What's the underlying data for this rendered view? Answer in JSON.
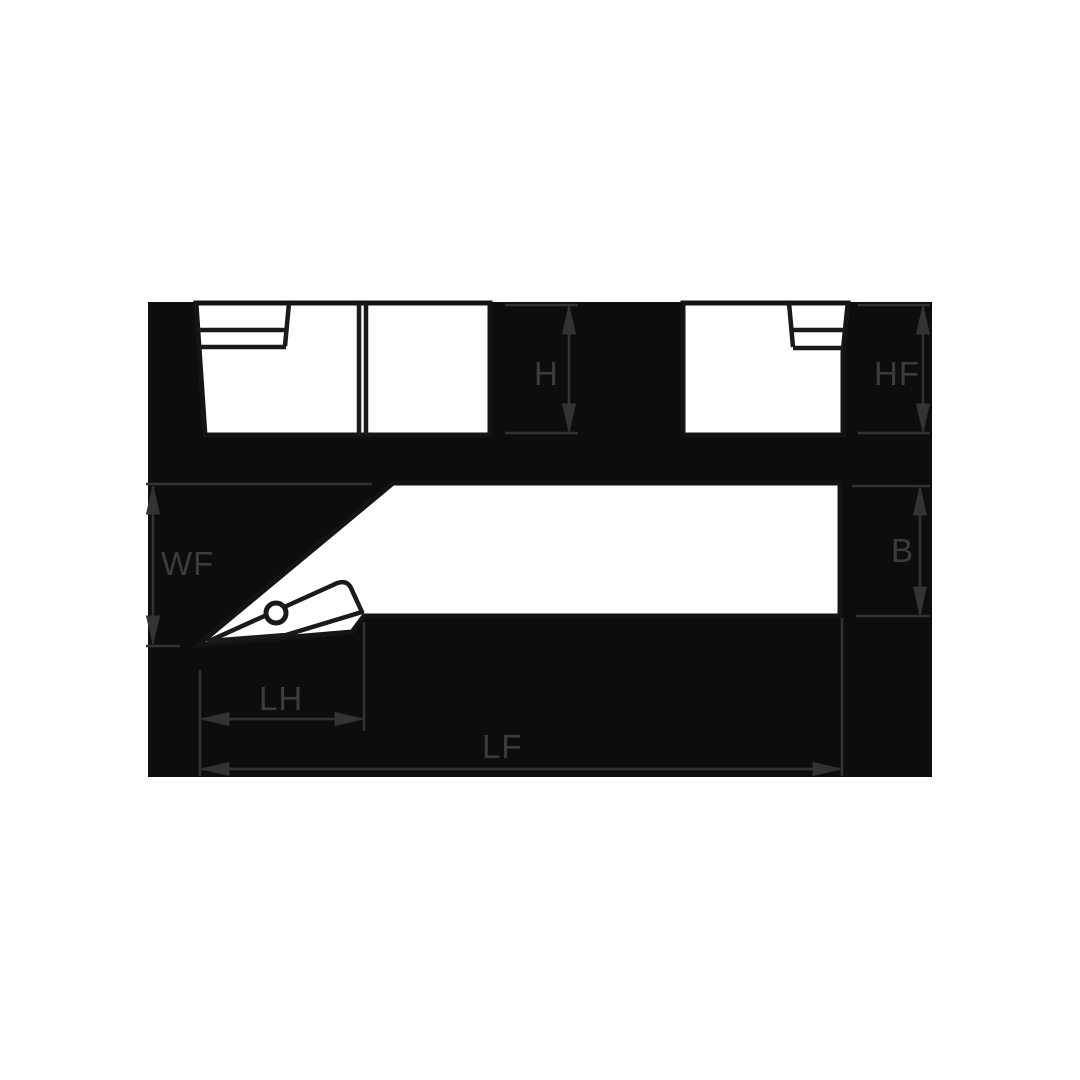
{
  "drawing": {
    "type": "tool-holder-dimension-diagram",
    "labels": {
      "h": "H",
      "hf": "HF",
      "wf": "WF",
      "b": "B",
      "lh": "LH",
      "lf": "LF"
    },
    "colors": {
      "page_background": "#ffffff",
      "panel": "#0d0d0d",
      "shape_fill": "#ffffff",
      "shape_outline": "#141414",
      "insert_line": "#1a1a1a",
      "dimension_lines": "#333333",
      "label_text": "#3c3c3c"
    }
  }
}
